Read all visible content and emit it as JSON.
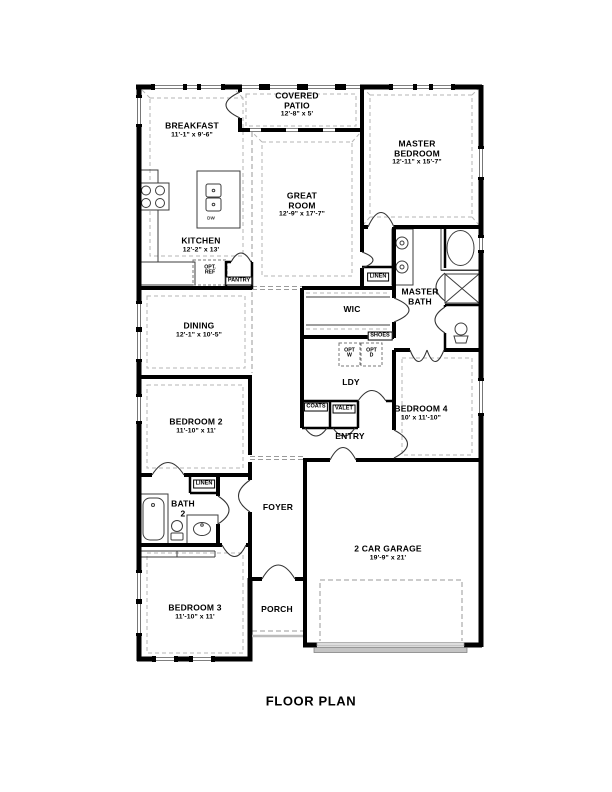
{
  "title": "FLOOR PLAN",
  "rooms": {
    "breakfast": {
      "name": "BREAKFAST",
      "dims": "11'-1\" x 9'-6\""
    },
    "covered_patio": {
      "line1": "COVERED",
      "line2": "PATIO",
      "dims": "12'-8\" x 5'"
    },
    "master_bedroom": {
      "line1": "MASTER",
      "line2": "BEDROOM",
      "dims": "12'-11\" x 15'-7\""
    },
    "great_room": {
      "line1": "GREAT",
      "line2": "ROOM",
      "dims": "12'-9\" x 17'-7\""
    },
    "kitchen": {
      "name": "KITCHEN",
      "dims": "12'-2\" x 13'"
    },
    "dining": {
      "name": "DINING",
      "dims": "12'-1\" x 10'-5\""
    },
    "master_bath": {
      "line1": "MASTER",
      "line2": "BATH"
    },
    "wic": {
      "name": "WIC"
    },
    "ldy": {
      "name": "LDY"
    },
    "entry": {
      "name": "ENTRY"
    },
    "foyer": {
      "name": "FOYER"
    },
    "bedroom_2": {
      "name": "BEDROOM 2",
      "dims": "11'-10\" x 11'"
    },
    "bedroom_3": {
      "name": "BEDROOM 3",
      "dims": "11'-10\" x 11'"
    },
    "bedroom_4": {
      "name": "BEDROOM 4",
      "dims": "10' x 11'-10\""
    },
    "bath_2": {
      "line1": "BATH",
      "line2": "2"
    },
    "garage": {
      "name": "2 CAR GARAGE",
      "dims": "19'-9\" x 21'"
    },
    "porch": {
      "name": "PORCH"
    }
  },
  "closets": {
    "linen_master": "LINEN",
    "linen_bath2": "LINEN",
    "shoes": "SHOES",
    "coats": "COATS",
    "valet": "VALET",
    "pantry": "PANTRY"
  },
  "appliances": {
    "dw": "DW",
    "opt_ref_line1": "OPT.",
    "opt_ref_line2": "REF",
    "opt_w_line1": "OPT",
    "opt_w_line2": "W",
    "opt_d_line1": "OPT",
    "opt_d_line2": "D"
  },
  "colors": {
    "wall": "#000000",
    "dashed_line": "#aaaaaa",
    "thin_line": "#3c3c3c",
    "garage_door": "#c4c4c4"
  }
}
